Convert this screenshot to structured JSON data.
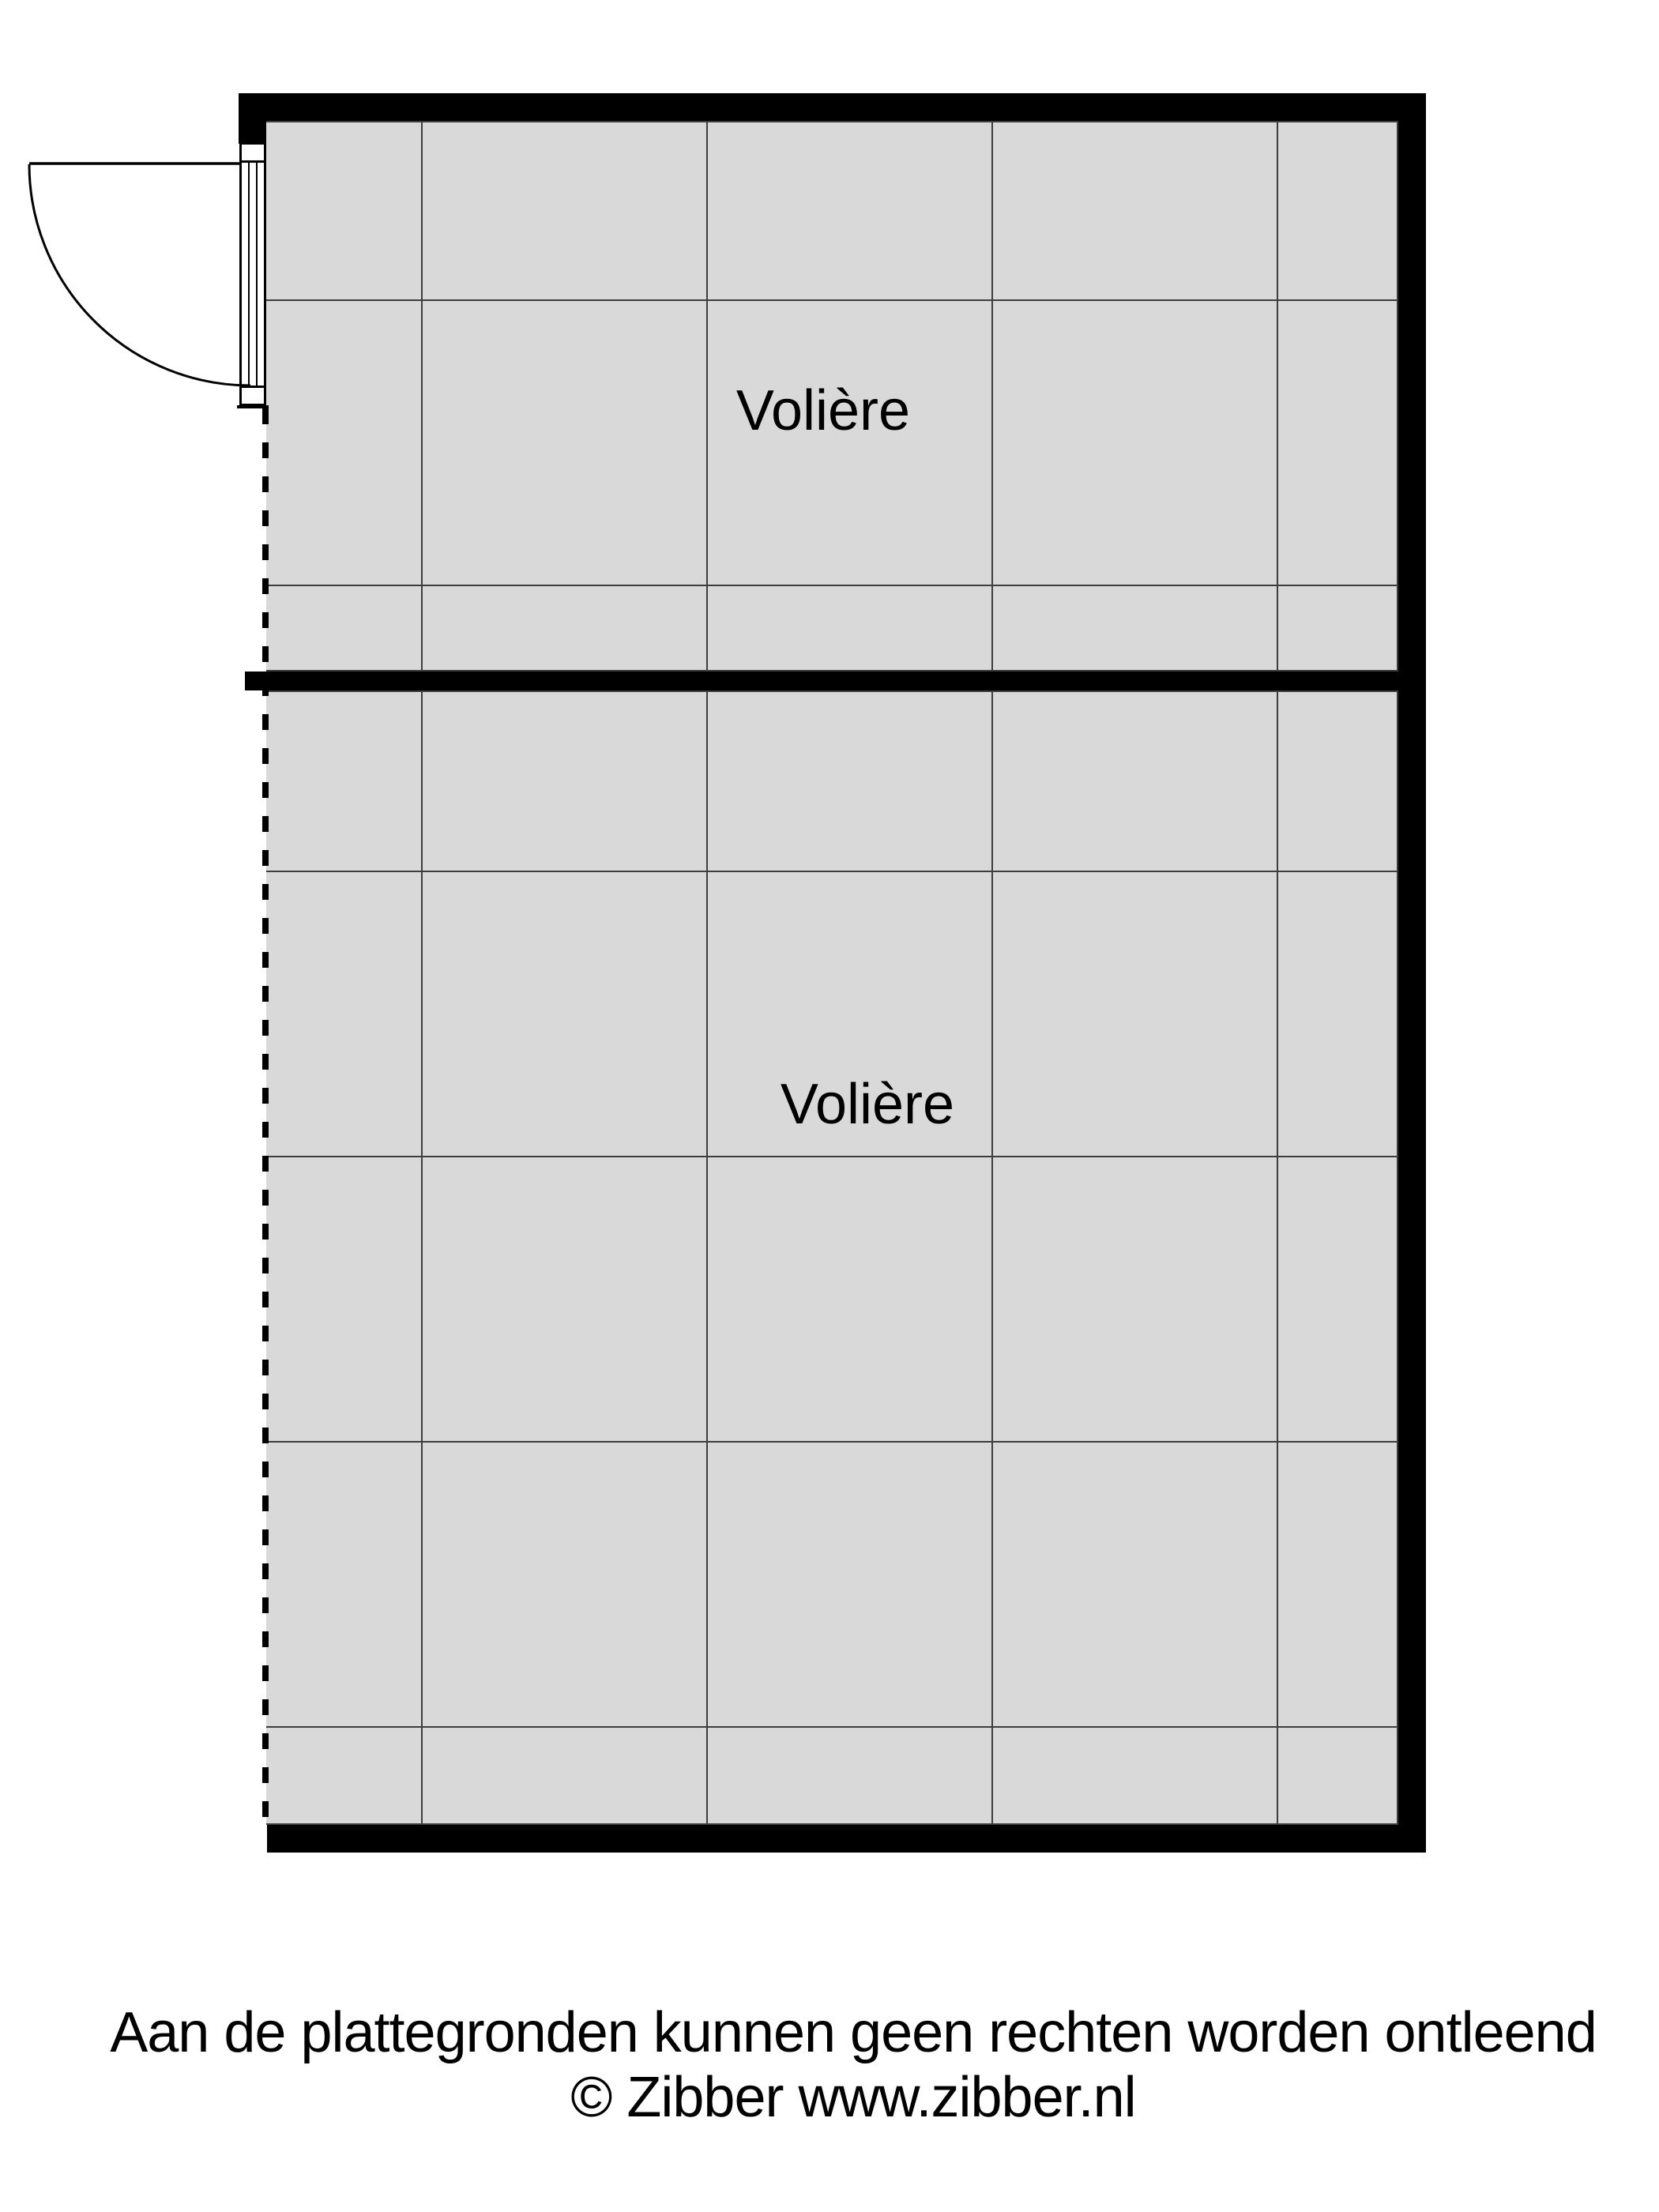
{
  "floorplan": {
    "rooms": [
      {
        "label": "Volière"
      },
      {
        "label": "Volière"
      }
    ]
  },
  "footer": {
    "line1": "Aan de plattegronden kunnen geen rechten worden ontleend",
    "line2": "© Zibber www.zibber.nl"
  },
  "colors": {
    "wall": "#000000",
    "room_fill": "#d9d9d9",
    "grid_line": "#3d3d3d",
    "text": "#000000",
    "background": "#ffffff"
  }
}
